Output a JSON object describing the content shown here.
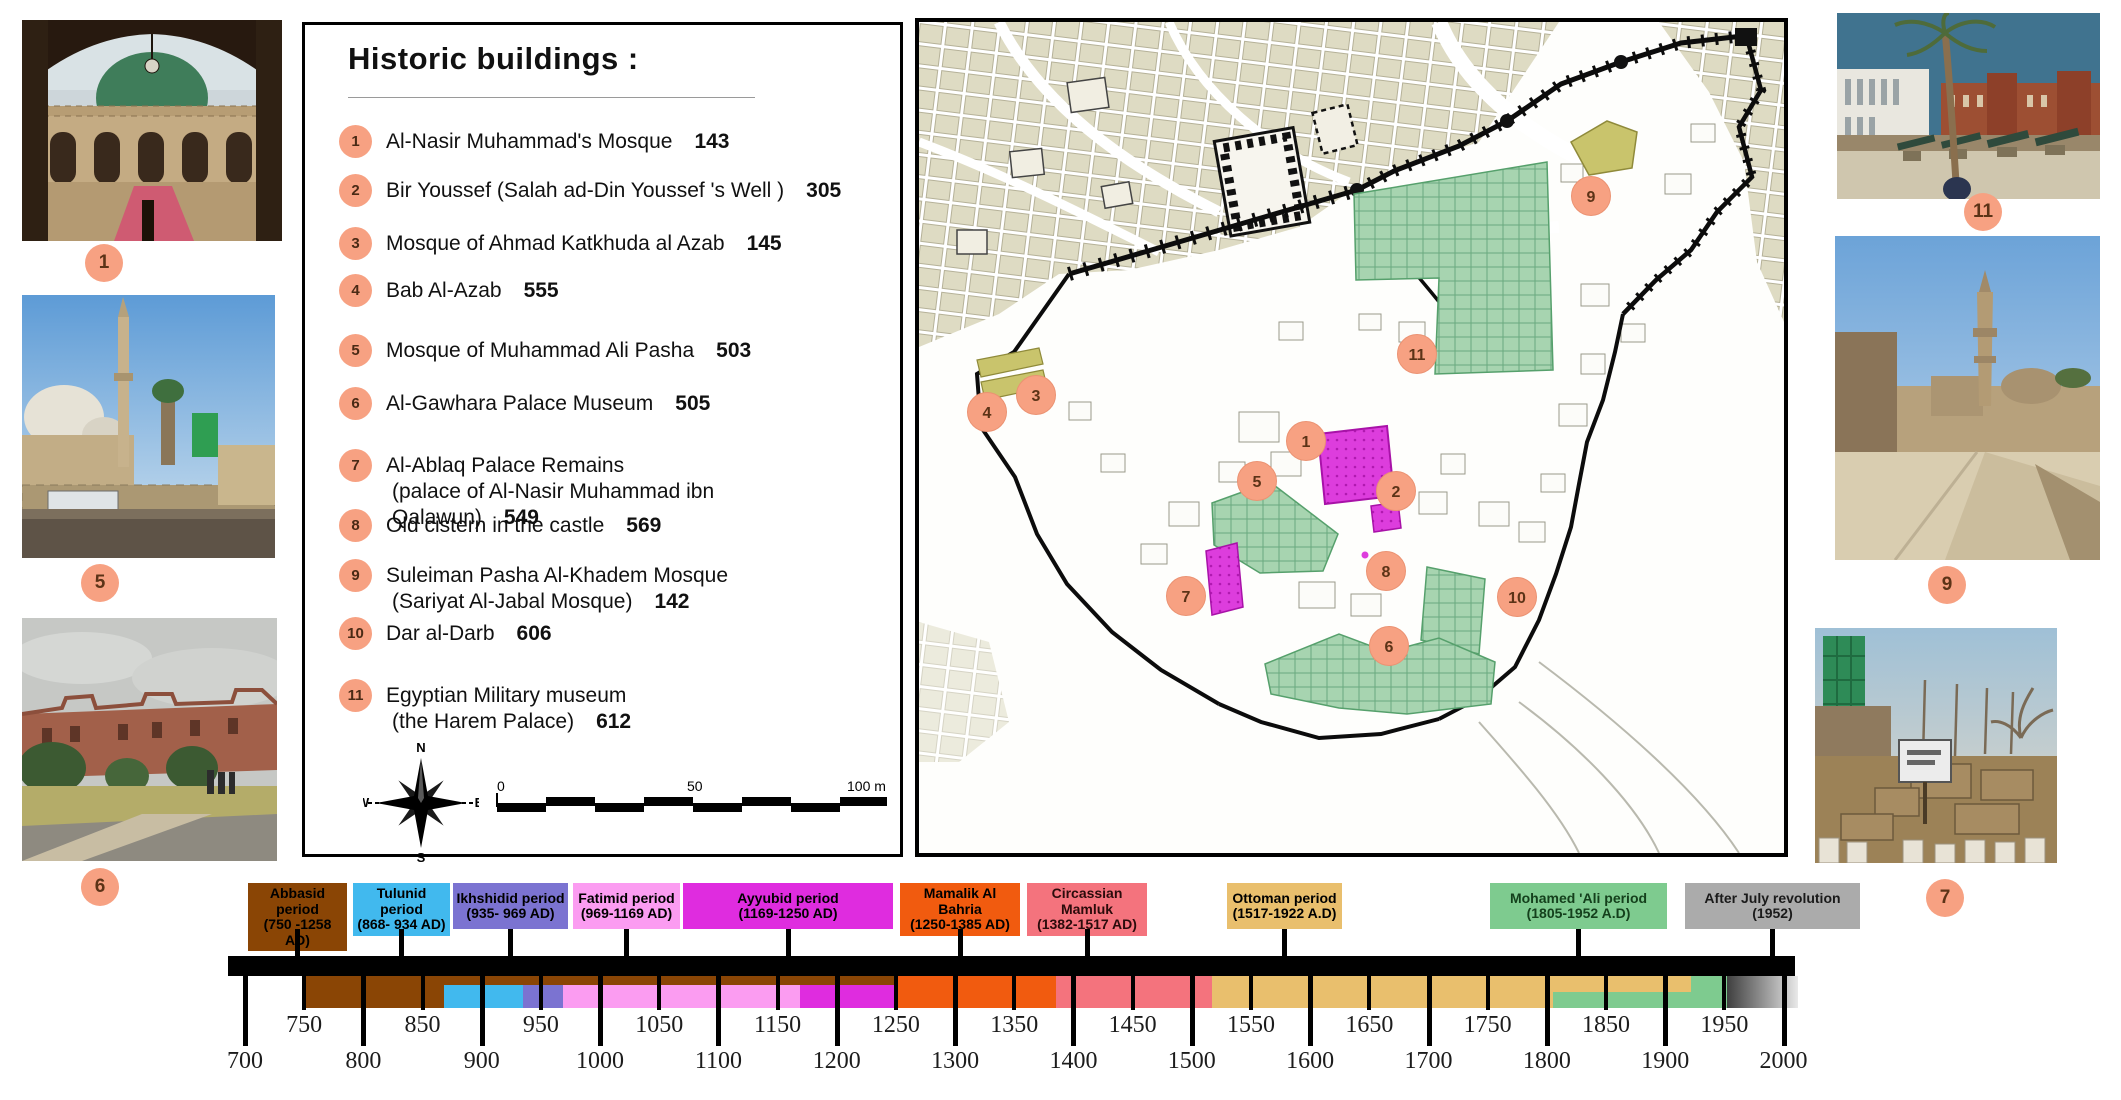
{
  "colors": {
    "marker_fill": "#f7a182",
    "map_green": "#a7d4b0",
    "map_magenta": "#dd3ddd",
    "map_khaki": "#c9c46c",
    "map_beige": "#dedbc3"
  },
  "legend": {
    "title": "Historic buildings :",
    "items": [
      {
        "num": "1",
        "label": "Al-Nasir Muhammad's Mosque",
        "value": "143",
        "y": 104
      },
      {
        "num": "2",
        "label": "Bir Youssef  (Salah ad-Din Youssef 's Well )",
        "value": "305",
        "y": 153
      },
      {
        "num": "3",
        "label": "Mosque of Ahmad Katkhuda al Azab",
        "value": "145",
        "y": 206
      },
      {
        "num": "4",
        "label": "Bab Al-Azab",
        "value": "555",
        "y": 253
      },
      {
        "num": "5",
        "label": "Mosque of Muhammad Ali Pasha",
        "value": "503",
        "y": 313
      },
      {
        "num": "6",
        "label": "Al-Gawhara Palace Museum",
        "value": "505",
        "y": 366
      },
      {
        "num": "7",
        "label": "Al-Ablaq Palace Remains",
        "line2": "(palace of Al-Nasir Muhammad ibn Qalawun)",
        "value": "549",
        "y": 428
      },
      {
        "num": "8",
        "label": "Old cistern in the castle",
        "value": "569",
        "y": 488
      },
      {
        "num": "9",
        "label": "Suleiman Pasha Al-Khadem Mosque",
        "line2": "(Sariyat Al-Jabal Mosque)",
        "value": "142",
        "y": 538
      },
      {
        "num": "10",
        "label": "Dar al-Darb",
        "value": "606",
        "y": 596
      },
      {
        "num": "11",
        "label": "Egyptian Military museum",
        "line2": "(the Harem Palace)",
        "value": "612",
        "y": 658
      }
    ],
    "compass": {
      "n": "N",
      "s": "S",
      "e": "E",
      "w": "W"
    },
    "scalebar": {
      "zero": "0",
      "fifty": "50",
      "hundred": "100 m"
    }
  },
  "photos": {
    "left": [
      {
        "marker": "1"
      },
      {
        "marker": "5"
      },
      {
        "marker": "6"
      }
    ],
    "right": [
      {
        "marker": "11"
      },
      {
        "marker": "9"
      },
      {
        "marker": "7"
      }
    ]
  },
  "map": {
    "markers": [
      {
        "id": "1",
        "x": 387,
        "y": 419
      },
      {
        "id": "2",
        "x": 477,
        "y": 469
      },
      {
        "id": "3",
        "x": 117,
        "y": 373
      },
      {
        "id": "4",
        "x": 68,
        "y": 390
      },
      {
        "id": "5",
        "x": 338,
        "y": 459
      },
      {
        "id": "6",
        "x": 470,
        "y": 624
      },
      {
        "id": "7",
        "x": 267,
        "y": 574
      },
      {
        "id": "8",
        "x": 467,
        "y": 549
      },
      {
        "id": "9",
        "x": 672,
        "y": 174
      },
      {
        "id": "10",
        "x": 598,
        "y": 575
      },
      {
        "id": "11",
        "x": 498,
        "y": 332
      }
    ]
  },
  "timeline": {
    "axis": {
      "x0": 245,
      "year0": 700,
      "px_per_year": 1.1835
    },
    "major_ticks": [
      700,
      800,
      900,
      1000,
      1100,
      1200,
      1300,
      1400,
      1500,
      1600,
      1700,
      1800,
      1900,
      2000
    ],
    "minor_ticks": [
      750,
      850,
      950,
      1050,
      1150,
      1250,
      1350,
      1450,
      1550,
      1650,
      1750,
      1850,
      1950
    ],
    "periods": [
      {
        "label": "Abbasid period",
        "years": "(750 -1258 AD)",
        "color": "#8a4505",
        "text_color": "#000000",
        "x": 248,
        "w": 99
      },
      {
        "label": "Tulunid  period",
        "years": "(868- 934 AD)",
        "color": "#41b9ee",
        "text_color": "#000000",
        "x": 353,
        "w": 97
      },
      {
        "label": "Ikhshidid  period",
        "years": "(935- 969 AD)",
        "color": "#7b73d1",
        "text_color": "#000000",
        "x": 453,
        "w": 115
      },
      {
        "label": "Fatimid period",
        "years": "(969-1169 AD)",
        "color": "#fb9cf1",
        "text_color": "#000000",
        "x": 573,
        "w": 107
      },
      {
        "label": "Ayyubid period",
        "years": "(1169-1250 AD)",
        "color": "#df2cdf",
        "text_color": "#000000",
        "x": 683,
        "w": 210
      },
      {
        "label": "Mamalik Al Bahria",
        "years": "(1250-1385 AD)",
        "color": "#f15b0f",
        "text_color": "#000000",
        "x": 900,
        "w": 120
      },
      {
        "label": "Circassian Mamluk",
        "years": "(1382-1517 AD)",
        "color": "#f4737d",
        "text_color": "#2b0b0b",
        "x": 1027,
        "w": 120
      },
      {
        "label": "Ottoman  period",
        "years": "(1517-1922 A.D)",
        "color": "#e9bf6d",
        "text_color": "#000000",
        "x": 1227,
        "w": 115
      },
      {
        "label": "Mohamed 'Ali period",
        "years": "(1805-1952 A.D)",
        "color": "#7ecb8f",
        "text_color": "#14401c",
        "x": 1490,
        "w": 177
      },
      {
        "label": "After July revolution",
        "years": "(1952)",
        "color": "#ababab",
        "text_color": "#1a1a1a",
        "x": 1685,
        "w": 175
      }
    ],
    "band_segments": [
      {
        "from": 750,
        "to": 868,
        "color": "#8a4505",
        "part": "full"
      },
      {
        "from": 868,
        "to": 1250,
        "color": "#8a4505",
        "part": "top"
      },
      {
        "from": 868,
        "to": 935,
        "color": "#41b9ee",
        "part": "lower"
      },
      {
        "from": 935,
        "to": 969,
        "color": "#7b73d1",
        "part": "lower"
      },
      {
        "from": 969,
        "to": 1169,
        "color": "#fb9cf1",
        "part": "lower"
      },
      {
        "from": 1169,
        "to": 1250,
        "color": "#df2cdf",
        "part": "lower"
      },
      {
        "from": 1250,
        "to": 1385,
        "color": "#f15b0f",
        "part": "full"
      },
      {
        "from": 1385,
        "to": 1517,
        "color": "#f4737d",
        "part": "full"
      },
      {
        "from": 1517,
        "to": 1805,
        "color": "#e9bf6d",
        "part": "full"
      },
      {
        "from": 1805,
        "to": 1922,
        "color": "#e9bf6d",
        "part": "tophalf"
      },
      {
        "from": 1805,
        "to": 1952,
        "color": "#7ecb8f",
        "part": "bottomhalf"
      },
      {
        "from": 1922,
        "to": 1952,
        "color": "#7ecb8f",
        "part": "full"
      },
      {
        "from": 1952,
        "to": 2012,
        "color": "gray-gradient",
        "part": "full"
      }
    ]
  }
}
